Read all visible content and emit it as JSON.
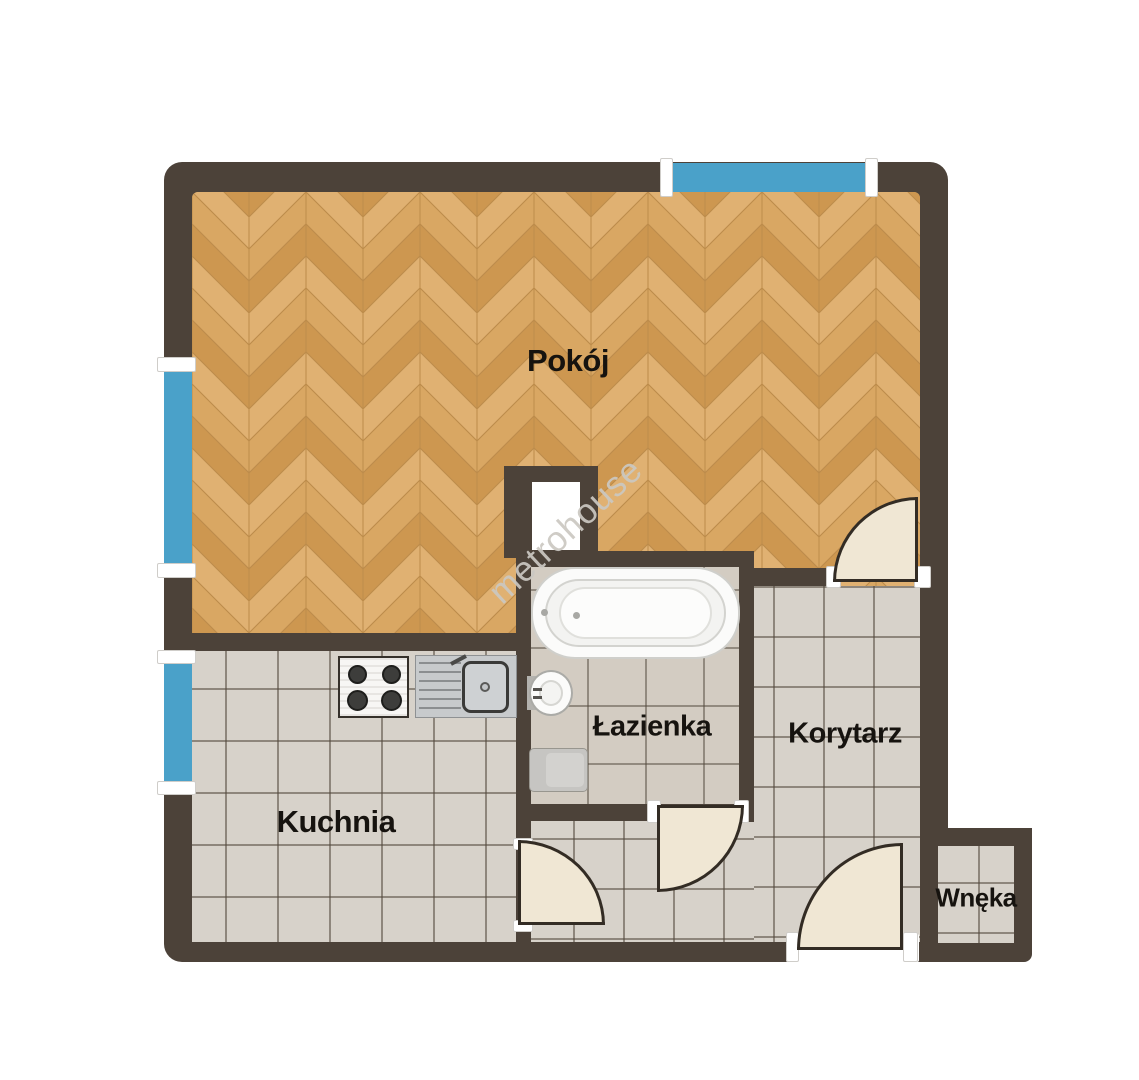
{
  "floorplan": {
    "watermark_text": "metrohouse",
    "rooms": [
      {
        "id": "pokoj",
        "label": "Pokój",
        "floor": "wood-herringbone"
      },
      {
        "id": "kuchnia",
        "label": "Kuchnia",
        "floor": "ceramic-tile"
      },
      {
        "id": "lazienka",
        "label": "Łazienka",
        "floor": "ceramic-tile"
      },
      {
        "id": "korytarz",
        "label": "Korytarz",
        "floor": "ceramic-tile"
      },
      {
        "id": "wneka",
        "label": "Wnęka",
        "floor": "ceramic-tile"
      }
    ],
    "fixtures": [
      {
        "name": "bathtub",
        "room": "lazienka"
      },
      {
        "name": "washbasin",
        "room": "lazienka"
      },
      {
        "name": "toilet",
        "room": "lazienka"
      },
      {
        "name": "gas-stove-4-burner",
        "room": "kuchnia"
      },
      {
        "name": "kitchen-sink-with-drainer",
        "room": "kuchnia"
      },
      {
        "name": "ventilation-shaft",
        "room": "lazienka"
      }
    ],
    "windows": [
      {
        "name": "window-north",
        "wall": "top"
      },
      {
        "name": "window-west-upper",
        "wall": "left"
      },
      {
        "name": "window-west-lower",
        "wall": "left"
      }
    ],
    "doors": [
      {
        "name": "door-pokoj-korytarz"
      },
      {
        "name": "door-lazienka-hall"
      },
      {
        "name": "door-kuchnia-hall"
      },
      {
        "name": "door-entrance"
      }
    ],
    "colors": {
      "wall": "#4c4239",
      "window_glass": "#4aa1c9",
      "door_leaf": "#f0e7d4",
      "wood_light": "#e0b172",
      "wood_mid": "#d9a763",
      "wood_dark": "#cd9750",
      "tile": "#d7d2ca",
      "tile_bath": "#d3ccc2",
      "label_text": "#16130f",
      "watermark": "#cbc8c2"
    }
  }
}
